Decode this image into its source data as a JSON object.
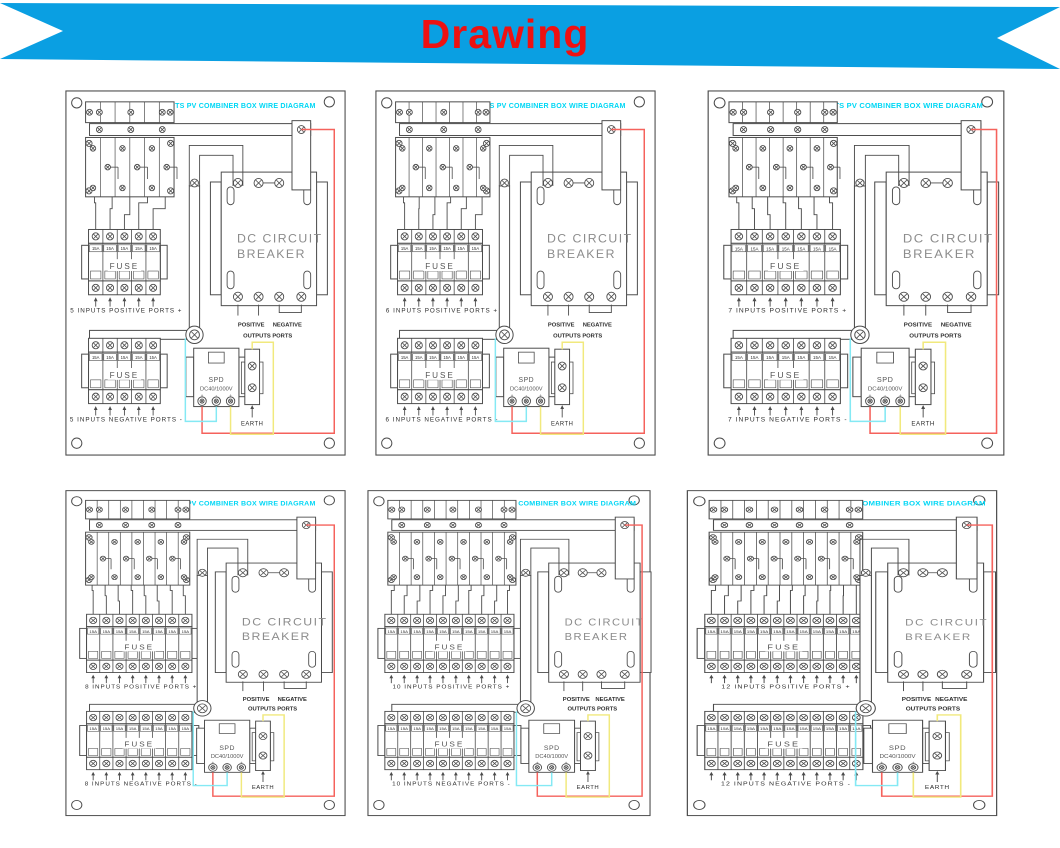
{
  "banner": {
    "title": "Drawing",
    "bg_color": "#0a9fe2",
    "text_color": "#ee1111"
  },
  "panels": [
    {
      "inputs": 5,
      "title": "5 INPUTS PV COMBINER BOX WIRE DIAGRAM",
      "positive_ports_label": "5 INPUTS POSITIVE PORTS +",
      "negative_ports_label": "5 INPUTS NEGATIVE PORTS -"
    },
    {
      "inputs": 6,
      "title": "6 INPUTS PV COMBINER BOX WIRE DIAGRAM",
      "positive_ports_label": "6 INPUTS POSITIVE PORTS +",
      "negative_ports_label": "6 INPUTS NEGATIVE PORTS -"
    },
    {
      "inputs": 7,
      "title": "7 INPUTS PV COMBINER BOX WIRE DIAGRAM",
      "positive_ports_label": "7 INPUTS POSITIVE PORTS +",
      "negative_ports_label": "7 INPUTS NEGATIVE PORTS -"
    },
    {
      "inputs": 8,
      "title": "8 INPUTS PV COMBINER BOX WIRE DIAGRAM",
      "positive_ports_label": "8 INPUTS POSITIVE PORTS +",
      "negative_ports_label": "8 INPUTS NEGATIVE PORTS -"
    },
    {
      "inputs": 10,
      "title": "10 INPUTS PV COMBINER BOX WIRE DIAGRAM",
      "positive_ports_label": "10 INPUTS POSITIVE PORTS +",
      "negative_ports_label": "10 INPUTS NEGATIVE PORTS -"
    },
    {
      "inputs": 12,
      "title": "12 INPUTS PV COMBINER BOX WIRE DIAGRAM",
      "positive_ports_label": "12 INPUTS POSITIVE PORTS +",
      "negative_ports_label": "12 INPUTS NEGATIVE PORTS -"
    }
  ],
  "shared": {
    "fuse_label": "FUSE",
    "fuse_rating": "15A",
    "breaker_label_line1": "DC  CIRCUIT",
    "breaker_label_line2": "BREAKER",
    "spd_label_line1": "SPD",
    "spd_label_line2": "DC40/1000V",
    "spd_terminal_marks": [
      "+",
      "-",
      "+"
    ],
    "earth_label": "EARTH",
    "outputs_positive_label": "POSITIVE",
    "outputs_negative_label": "NEGATIVE",
    "outputs_ports_label": "OUTPUTS PORTS"
  },
  "colors": {
    "title_cyan": "#00d7f5",
    "line": "#4b4b4b",
    "text_dark": "#2e2e2e",
    "breaker_text": "#8c8c8c",
    "wire_red": "#f5625c",
    "wire_cyan": "#84e9f4",
    "wire_yellow": "#f1e97d"
  }
}
